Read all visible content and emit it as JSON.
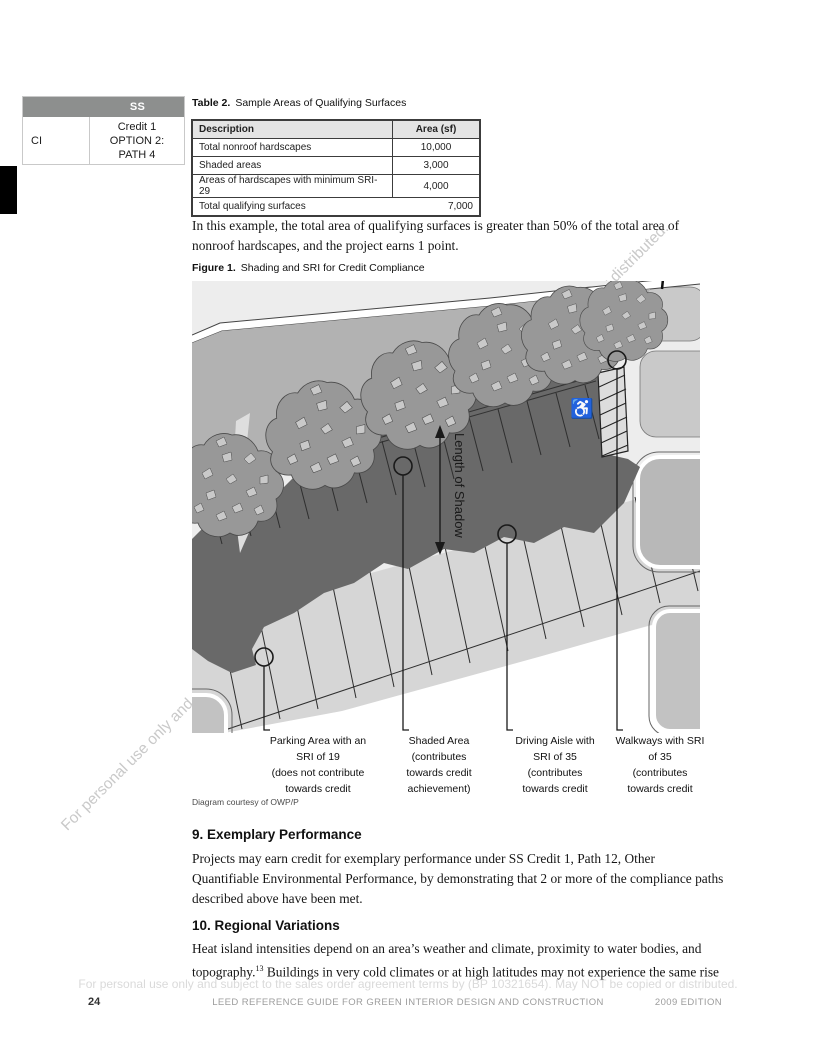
{
  "sidebar": {
    "header": "SS",
    "code": "CI",
    "credit": "Credit 1\nOPTION 2:\nPATH 4"
  },
  "table2": {
    "caption_label": "Table 2.",
    "caption_text": "Sample Areas of Qualifying Surfaces",
    "columns": [
      "Description",
      "Area (sf)"
    ],
    "rows": [
      [
        "Total nonroof hardscapes",
        "10,000"
      ],
      [
        "Shaded areas",
        "3,000"
      ],
      [
        "Areas of hardscapes with minimum SRI-29",
        "4,000"
      ]
    ],
    "total_row": {
      "label": "Total qualifying surfaces",
      "value": "7,000"
    }
  },
  "paragraphs": {
    "example": "In this example, the total area of qualifying surfaces is greater than 50% of the total area of nonroof hardscapes, and the project earns 1 point."
  },
  "figure": {
    "caption_label": "Figure 1.",
    "caption_text": "Shading and SRI for Credit Compliance",
    "length_of_shadow": "Length of Shadow",
    "handicap_symbol": "♿",
    "callouts": [
      {
        "label": "Parking Area with an\nSRI of 19\n(does not contribute\ntowards credit"
      },
      {
        "label": "Shaded Area\n(contributes\ntowards credit\nachievement)"
      },
      {
        "label": "Driving Aisle with\nSRI of 35\n(contributes\ntowards credit"
      },
      {
        "label": "Walkways with SRI\nof 35\n(contributes\ntowards credit"
      }
    ],
    "credit": "Diagram courtesy of OWP/P"
  },
  "sections": {
    "s9": {
      "heading": "9. Exemplary Performance",
      "body": "Projects may earn credit for exemplary performance under SS Credit 1, Path 12, Other Quantifiable Environmental Performance, by demonstrating that 2 or more of the compliance paths described above have been met."
    },
    "s10": {
      "heading": "10. Regional Variations",
      "body_a": "Heat island intensities depend on an area’s weather and climate, proximity to water bodies, and topography.",
      "footnote": "13",
      "body_b": " Buildings in very cold climates or at high latitudes may not experience the same rise"
    }
  },
  "watermark": {
    "text": "For personal use only and subject to the sales order agreement terms by (BP 10321654). May NOT be copied or distributed."
  },
  "footer": {
    "page_number": "24",
    "center": "LEED REFERENCE GUIDE FOR GREEN INTERIOR DESIGN AND CONSTRUCTION",
    "right": "2009 EDITION"
  },
  "colors": {
    "sidebar_header": "#8d8f8e",
    "shadow": "#696969",
    "canopy": "#989898",
    "strip": "#b2b2b2",
    "aisle_band": "#d6d6d6",
    "background": "#ededed"
  }
}
